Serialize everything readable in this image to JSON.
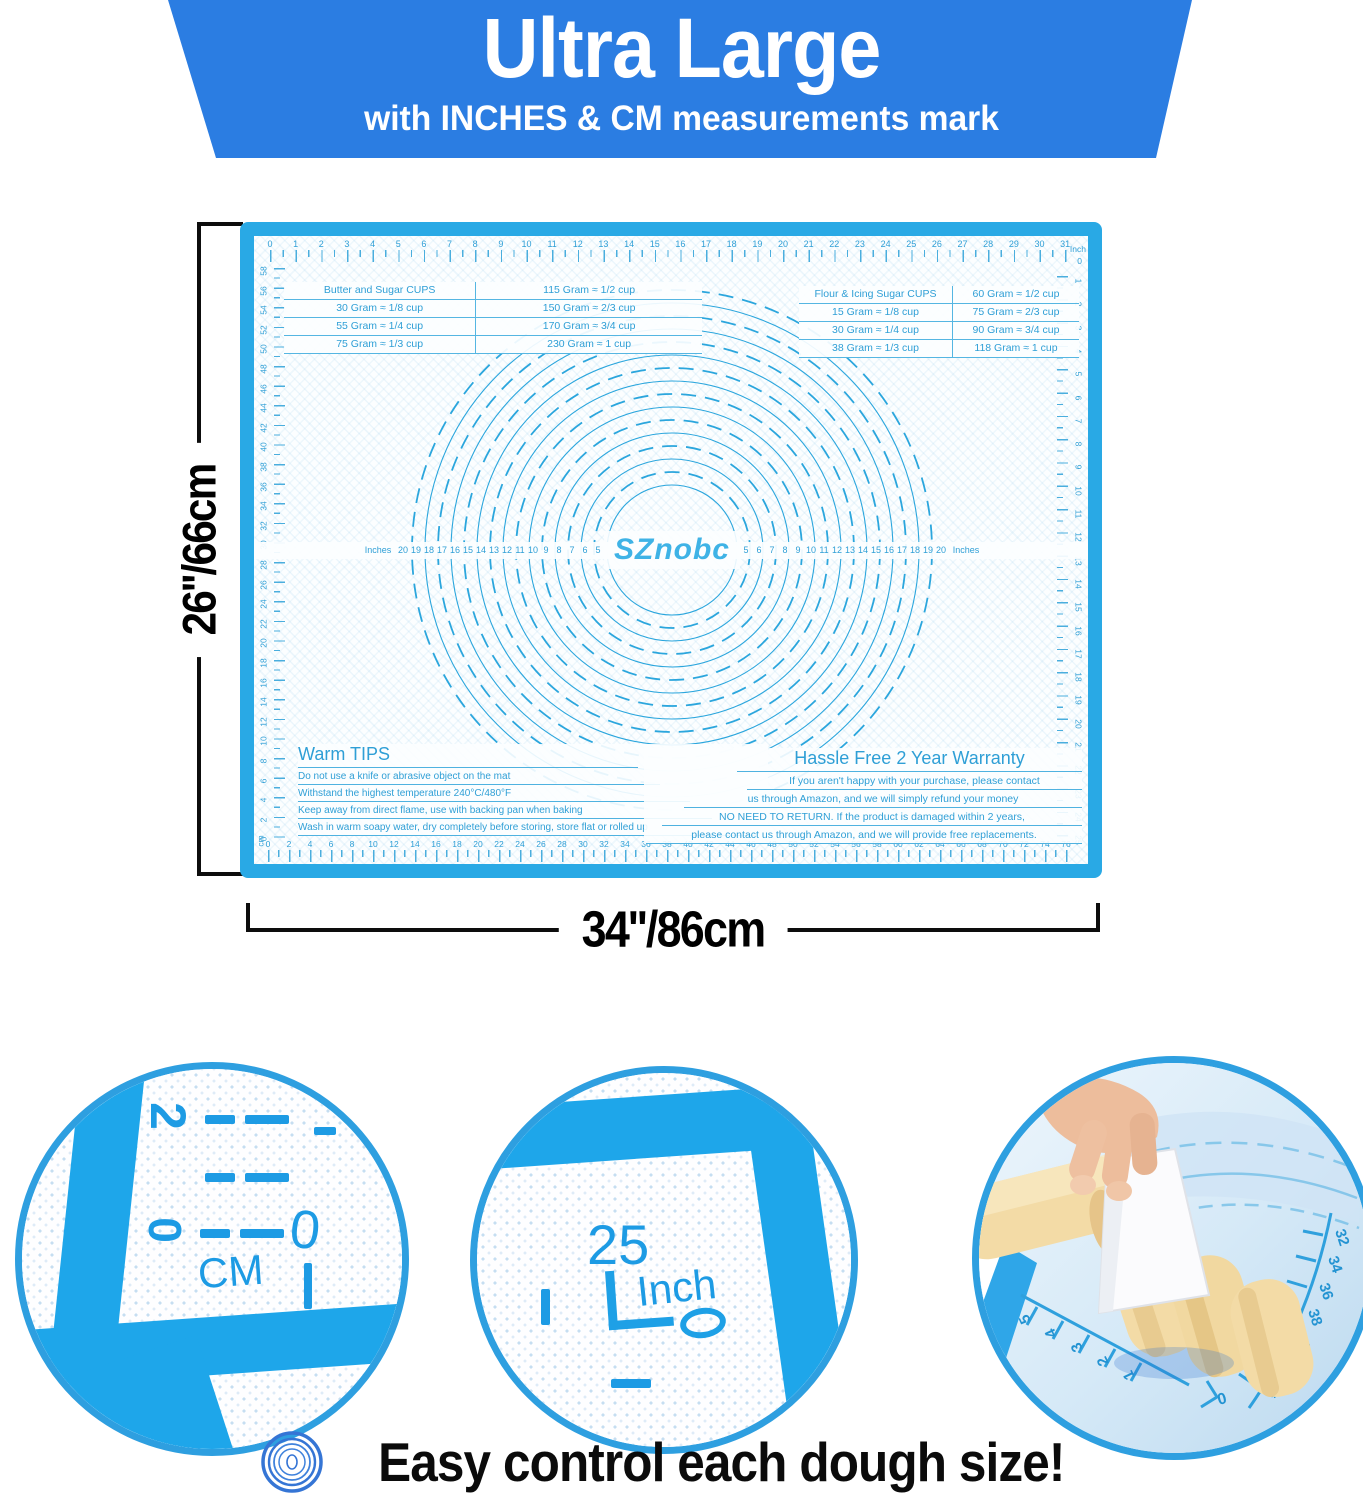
{
  "banner": {
    "title": "Ultra Large",
    "subtitle": "with INCHES & CM measurements mark",
    "color": "#2b7de2"
  },
  "dimensions": {
    "height_label": "26''/66cm",
    "width_label": "34''/86cm"
  },
  "mat": {
    "brand": "SZnobc",
    "border_color": "#29a9e5",
    "print_color": "#2f9fd6",
    "rulers": {
      "top_unit": "Inch",
      "top_corner_zero": "0",
      "bottom_unit": "cm",
      "top_numbers": [
        0,
        1,
        2,
        3,
        4,
        5,
        6,
        7,
        8,
        9,
        10,
        11,
        12,
        13,
        14,
        15,
        16,
        17,
        18,
        19,
        20,
        21,
        22,
        23,
        24,
        25,
        26,
        27,
        28,
        29,
        30,
        31
      ],
      "bottom_numbers": [
        0,
        2,
        4,
        6,
        8,
        10,
        12,
        14,
        16,
        18,
        20,
        22,
        24,
        26,
        28,
        30,
        32,
        34,
        36,
        38,
        40,
        42,
        44,
        46,
        48,
        50,
        52,
        54,
        56,
        58,
        60,
        62,
        64,
        66,
        68,
        70,
        72,
        74,
        76
      ],
      "left_numbers": [
        58,
        56,
        54,
        52,
        50,
        48,
        46,
        44,
        42,
        40,
        38,
        36,
        34,
        32,
        30,
        28,
        26,
        24,
        22,
        20,
        18,
        16,
        14,
        12,
        10,
        8,
        6,
        4,
        2,
        0
      ],
      "right_numbers": [
        1,
        2,
        3,
        4,
        5,
        6,
        7,
        8,
        9,
        10,
        11,
        12,
        13,
        14,
        15,
        16,
        17,
        18,
        19,
        20,
        21,
        22,
        23,
        24,
        25
      ]
    },
    "circle_band": {
      "left_unit": "Inches",
      "right_unit": "Inches",
      "numbers": [
        5,
        6,
        7,
        8,
        9,
        10,
        11,
        12,
        13,
        14,
        15,
        16,
        17,
        18,
        19,
        20
      ]
    },
    "left_table": {
      "rows": [
        [
          "Butter and Sugar CUPS",
          "115 Gram ≈ 1/2 cup"
        ],
        [
          "30 Gram ≈ 1/8 cup",
          "150 Gram ≈ 2/3 cup"
        ],
        [
          "55 Gram ≈ 1/4 cup",
          "170 Gram ≈ 3/4 cup"
        ],
        [
          "75 Gram ≈ 1/3 cup",
          "230 Gram ≈ 1 cup"
        ]
      ]
    },
    "right_table": {
      "rows": [
        [
          "Flour & Icing Sugar CUPS",
          "60 Gram ≈ 1/2 cup"
        ],
        [
          "15 Gram ≈ 1/8 cup",
          "75 Gram ≈ 2/3 cup"
        ],
        [
          "30 Gram ≈ 1/4 cup",
          "90 Gram ≈ 3/4 cup"
        ],
        [
          "38 Gram ≈ 1/3 cup",
          "118 Gram ≈ 1 cup"
        ]
      ]
    },
    "warm_tips": {
      "title": "Warm TIPS",
      "lines": [
        "Do not use a knife or abrasive object on the mat",
        "Withstand the highest temperature 240°C/480°F",
        "Keep away from direct flame, use with backing pan when baking",
        "Wash in warm soapy water, dry completely before storing, store flat or rolled up"
      ]
    },
    "warranty": {
      "title": "Hassle Free 2 Year Warranty",
      "lines": [
        "If you aren't happy with your purchase, please contact",
        "us through Amazon,  and we will simply refund your money",
        "NO NEED TO RETURN. If the product is damaged within 2 years,",
        "please contact us through Amazon, and we will provide free replacements."
      ]
    }
  },
  "callouts": {
    "cm_detail": {
      "top_number": "2",
      "mid_number": "0",
      "unit": "CM",
      "edge_number": "0"
    },
    "inch_detail": {
      "number": "25",
      "unit": "Inch",
      "zero": "0"
    },
    "dough_detail": {
      "left_numbers": [
        "5",
        "4",
        "3",
        "2",
        "1"
      ],
      "right_numbers": [
        "32",
        "34",
        "36",
        "38",
        "40",
        "42",
        "44"
      ],
      "corner_zero": "0"
    }
  },
  "footer": {
    "caption": "Easy control each dough size!"
  },
  "colors": {
    "banner_blue": "#2b7de2",
    "mat_border_blue": "#29a9e5",
    "print_blue": "#2f9fd6",
    "callout_ring_blue": "#2e9fe0",
    "dough_tan": "#f3dba6",
    "skin": "#edbd9c",
    "text_black": "#0d0d0d"
  }
}
